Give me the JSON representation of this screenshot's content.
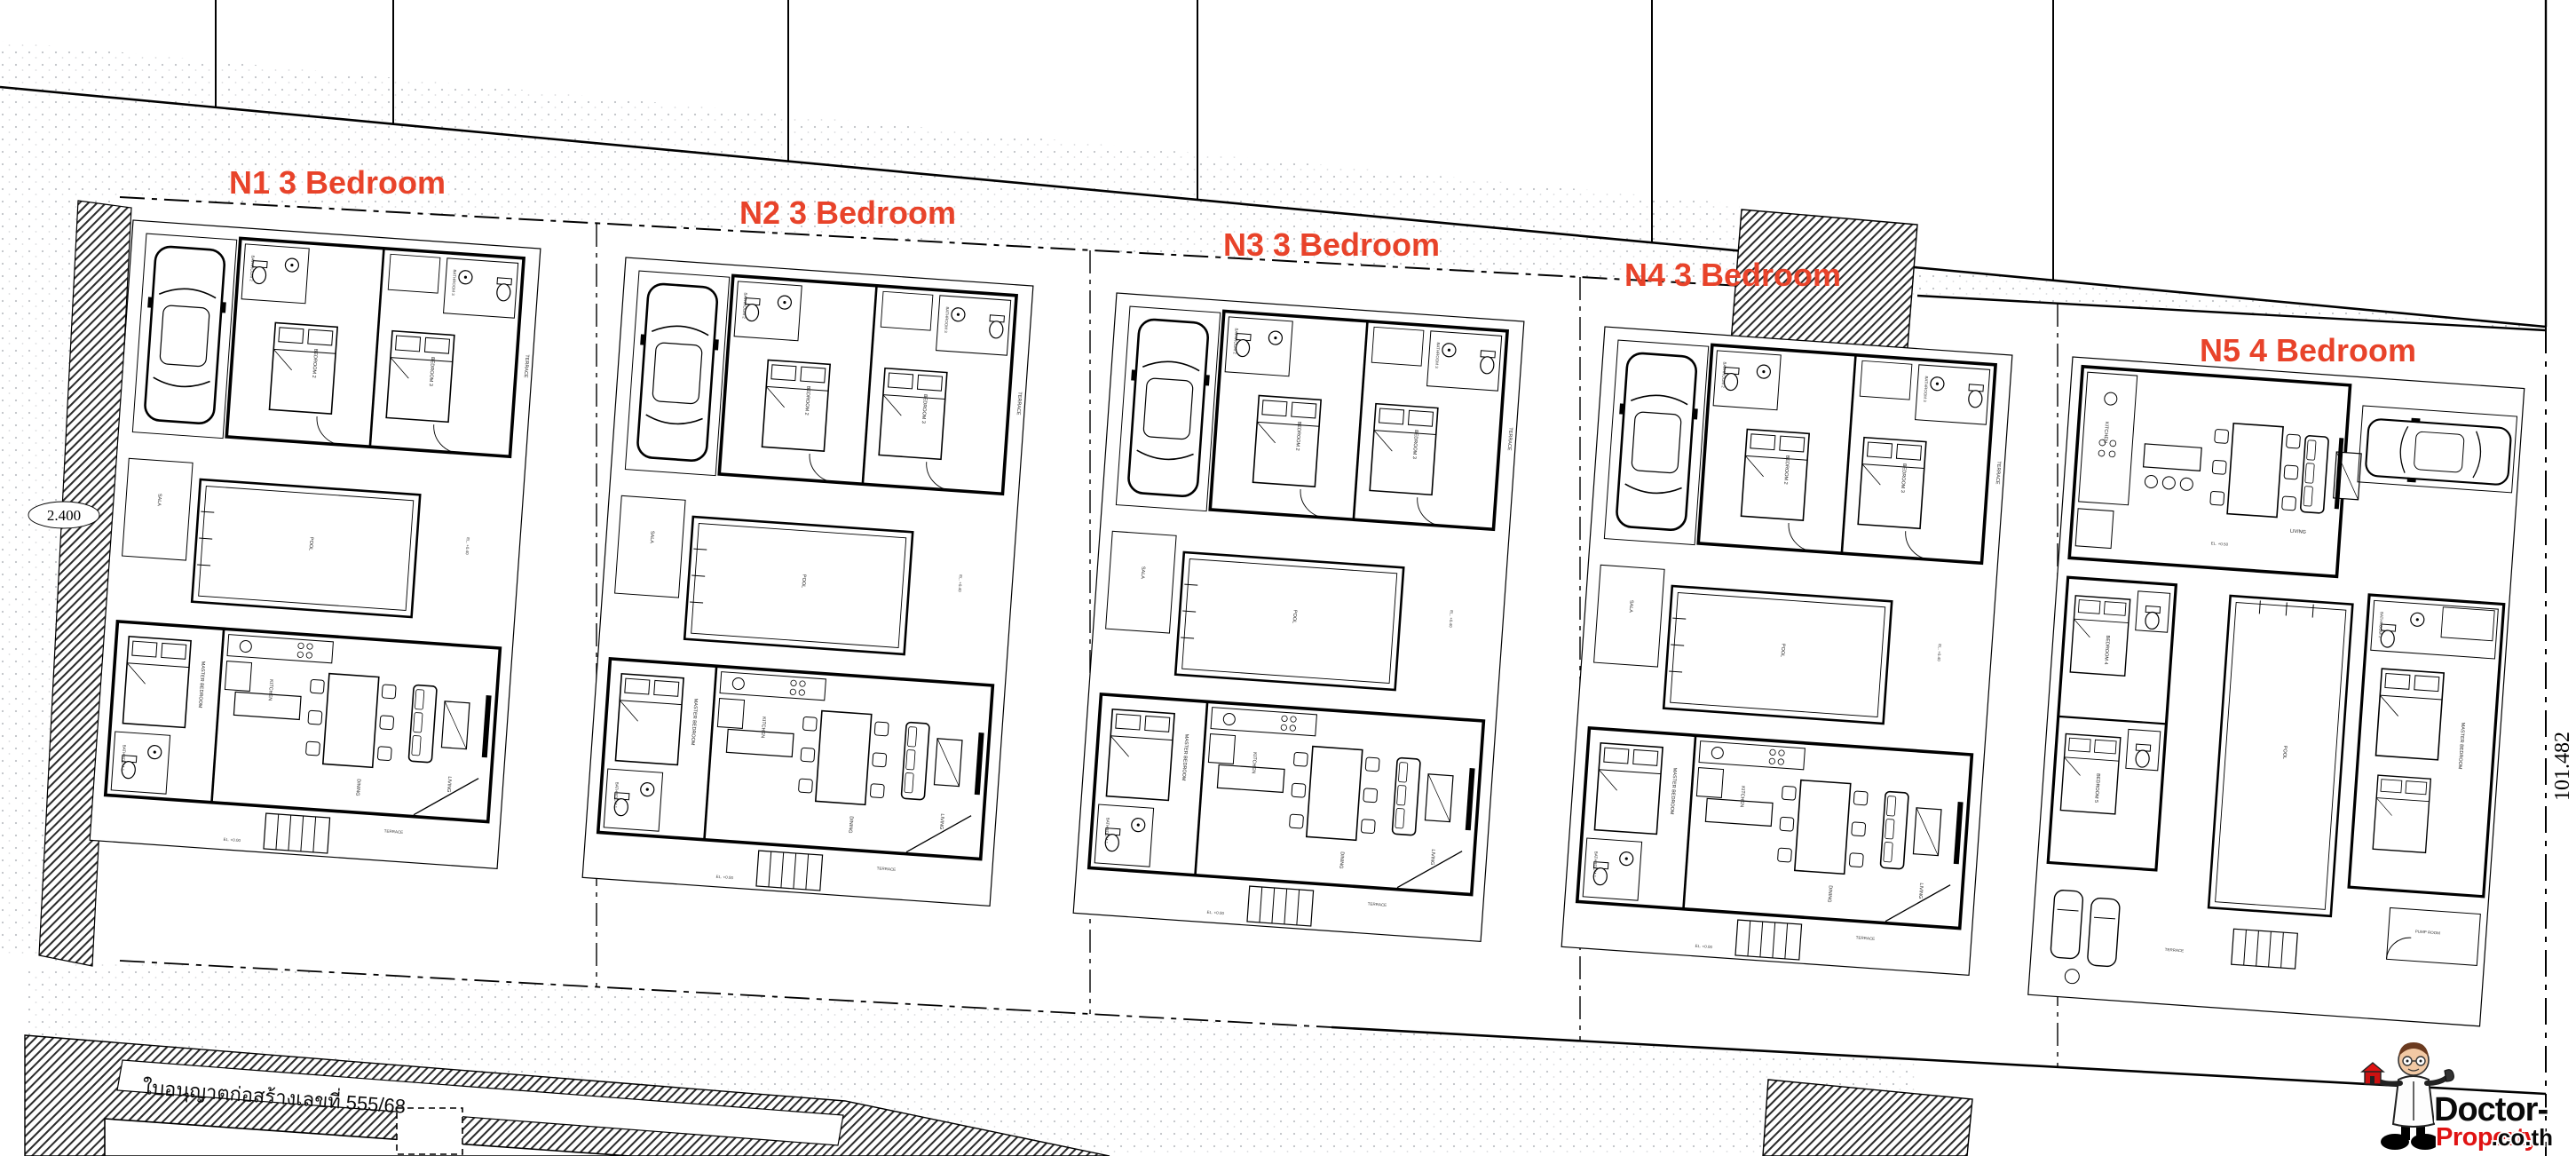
{
  "villas": [
    {
      "id": "N1",
      "label": "N1 3 Bedroom",
      "bedrooms": 3
    },
    {
      "id": "N2",
      "label": "N2 3 Bedroom",
      "bedrooms": 3
    },
    {
      "id": "N3",
      "label": "N3 3 Bedroom",
      "bedrooms": 3
    },
    {
      "id": "N4",
      "label": "N4 3 Bedroom",
      "bedrooms": 3
    },
    {
      "id": "N5",
      "label": "N5 4 Bedroom",
      "bedrooms": 4
    }
  ],
  "site": {
    "permit_text": "ใบอนุญาตก่อสร้างเลขที่  555/68",
    "dim_left": "2.400",
    "dim_right": "101.482"
  },
  "room_labels": {
    "bedroom2": "BEDROOM 2",
    "bedroom3": "BEDROOM 3",
    "bedroom4": "BEDROOM 4",
    "bedroom5": "BEDROOM 5",
    "master_bedroom": "MASTER BEDROOM",
    "bathroom1": "BATHROOM 1",
    "bathroom2": "BATHROOM 2",
    "bathroom3": "BATHROOM 3",
    "kitchen": "KITCHEN",
    "living": "LIVING",
    "dining": "DINING",
    "pool": "POOL",
    "terrace": "TERRACE",
    "sala": "SALA",
    "pump_room": "PUMP ROOM",
    "el_050": "EL. +0.50",
    "el_040": "EL. +0.40",
    "el_000": "EL. +0.00"
  },
  "logo": {
    "line1": "Doctor-",
    "line2_red": "Property",
    "line2_black": ".co.th"
  },
  "colors": {
    "accent_red": "#e8432a",
    "logo_red": "#e01313",
    "line_black": "#000000"
  }
}
